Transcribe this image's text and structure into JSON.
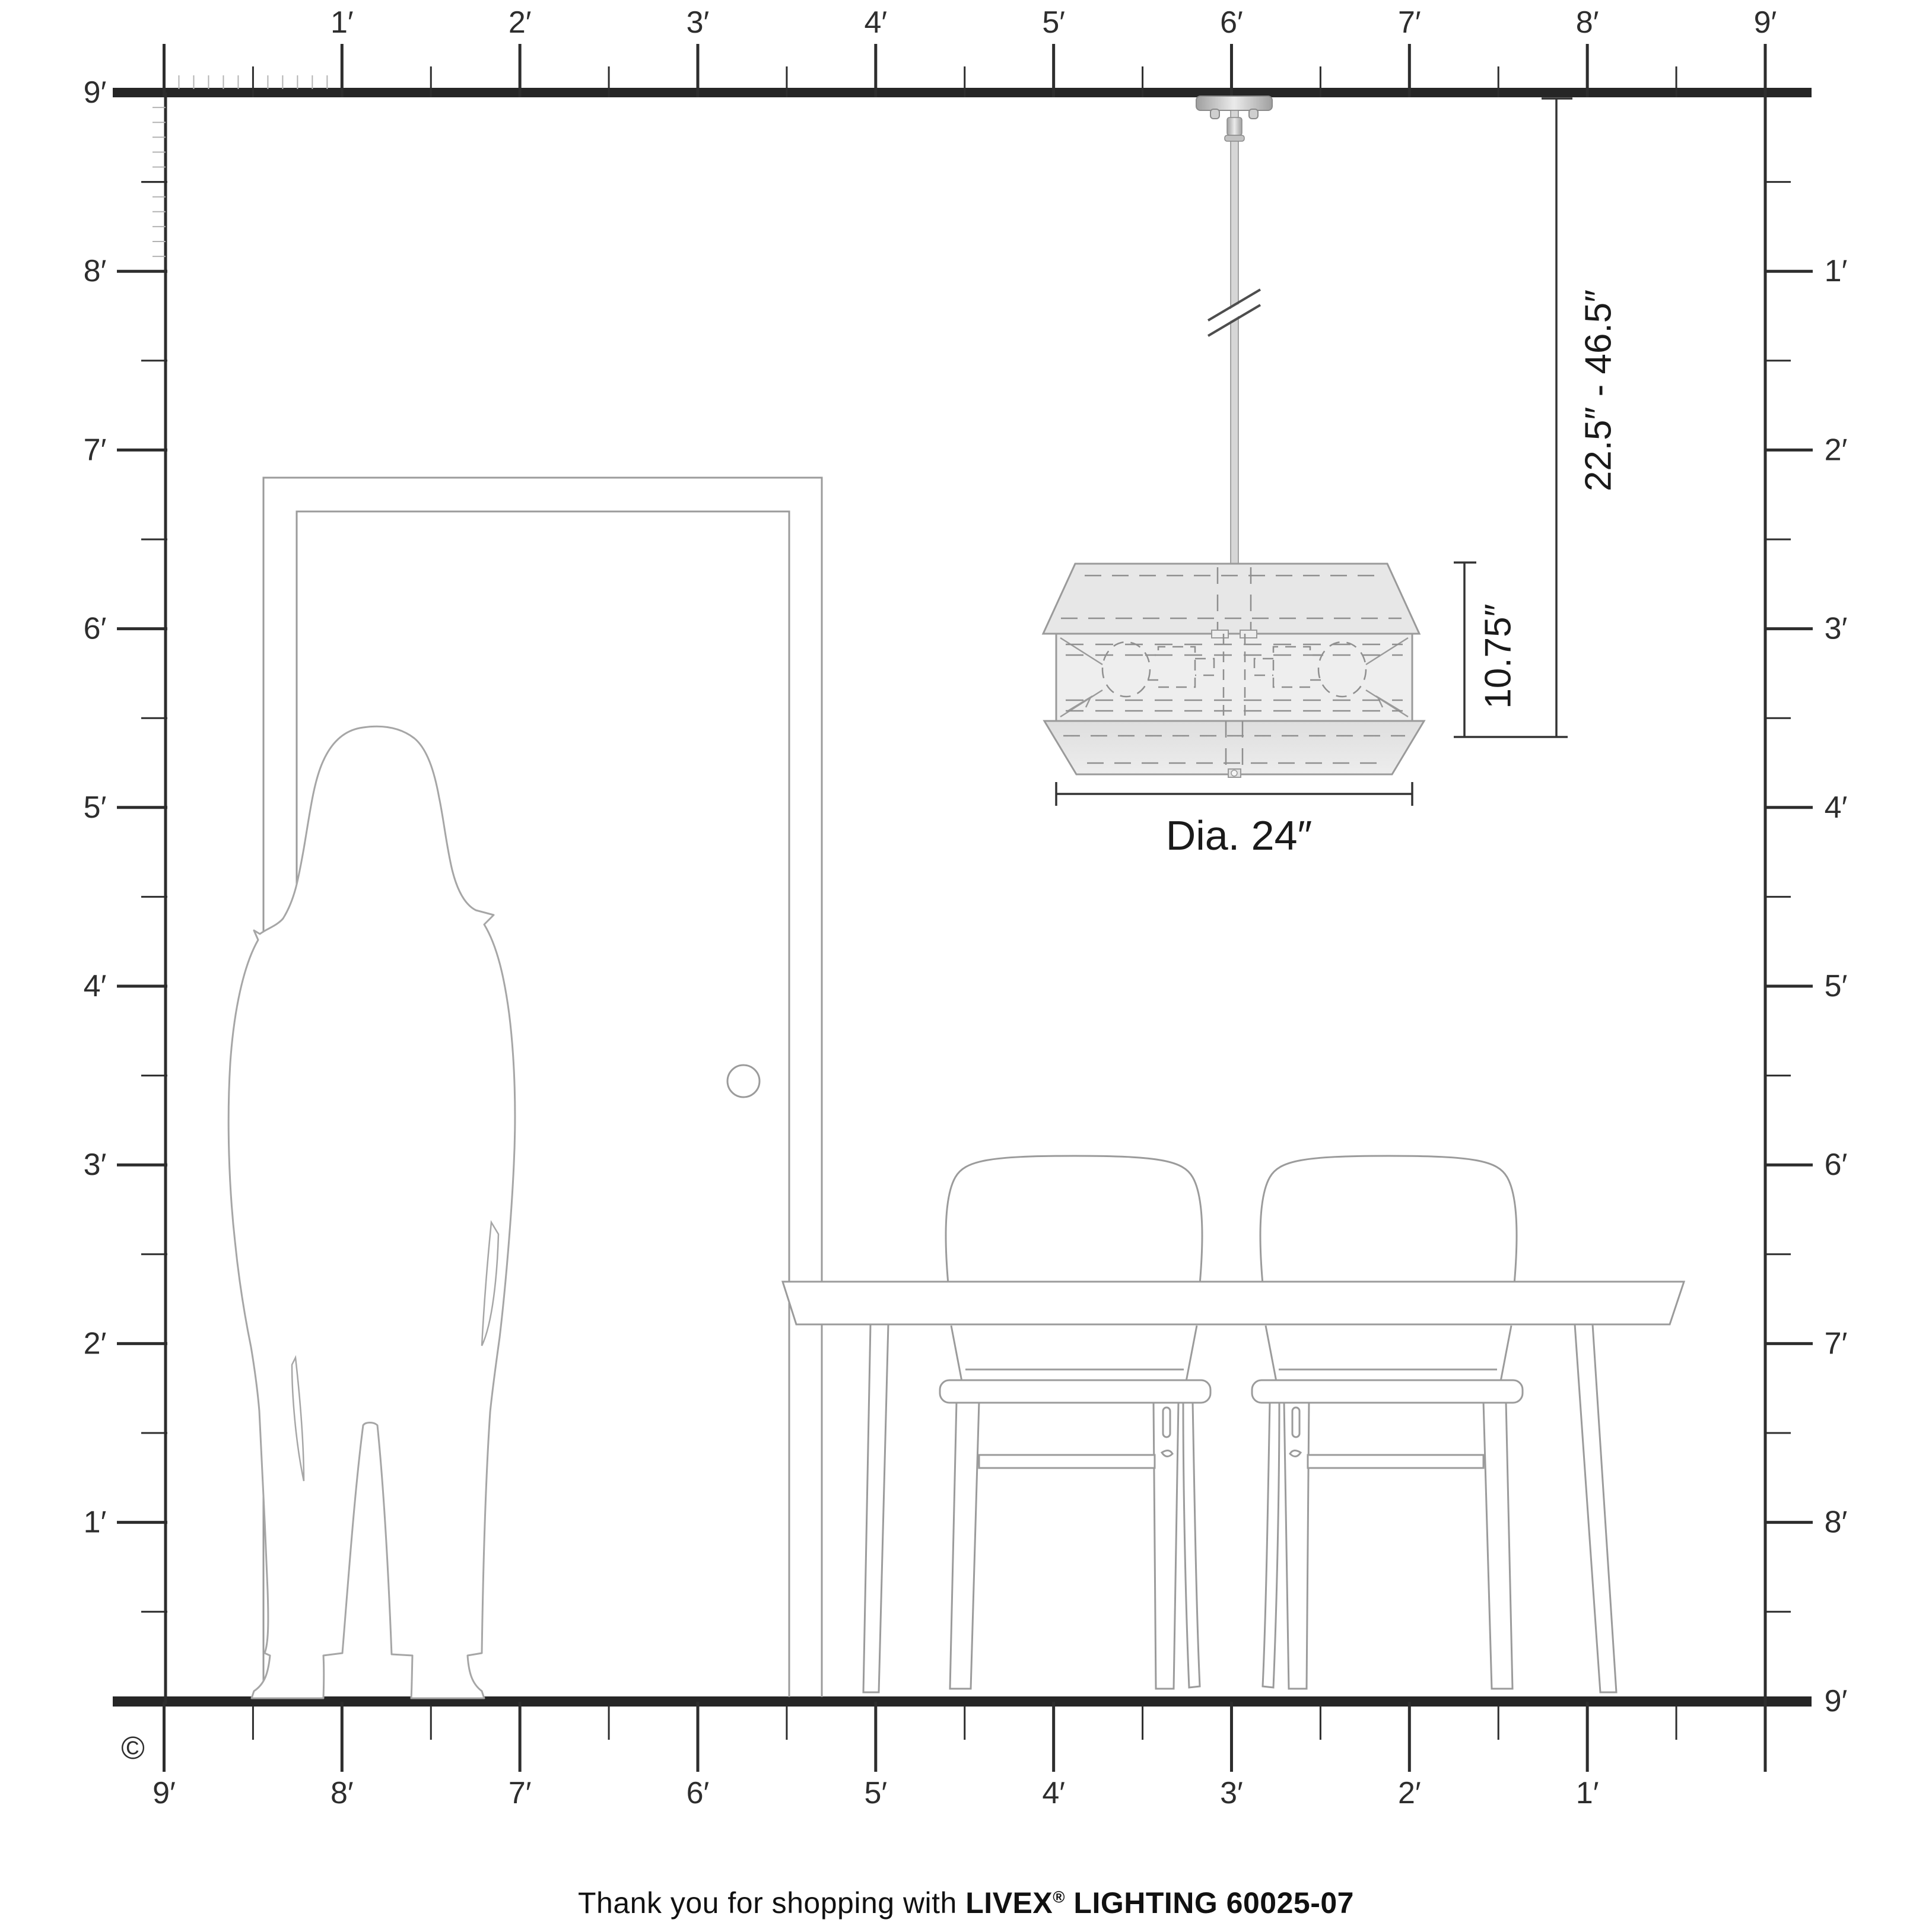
{
  "rulers": {
    "top": {
      "labels": [
        "1′",
        "2′",
        "3′",
        "4′",
        "5′",
        "6′",
        "7′",
        "8′",
        "9′"
      ]
    },
    "left": {
      "labels": [
        "9′",
        "8′",
        "7′",
        "6′",
        "5′",
        "4′",
        "3′",
        "2′",
        "1′"
      ]
    },
    "right": {
      "labels": [
        "1′",
        "2′",
        "3′",
        "4′",
        "5′",
        "6′",
        "7′",
        "8′",
        "9′"
      ]
    },
    "bottom": {
      "labels": [
        "9′",
        "8′",
        "7′",
        "6′",
        "5′",
        "4′",
        "3′",
        "2′",
        "1′"
      ]
    }
  },
  "annotations": {
    "hang_range": "22.5″ - 46.5″",
    "fixture_height": "10.75″",
    "diameter": "Dia. 24″"
  },
  "footer": {
    "prefix": "Thank you for shopping with ",
    "brand": "LIVEX",
    "registered": "®",
    "product": " LIGHTING 60025-07"
  },
  "copyright": "©",
  "colors": {
    "band": "#262626",
    "tick": "#2d2d2d",
    "inch_tick": "#b3b3b3",
    "furniture_line": "#9b9b9b",
    "silhouette_line": "#a6a6a6",
    "fixture_line": "#9a9a9a",
    "fixture_fill": "#e9e9e9",
    "fixture_fill_light": "#efefef",
    "dash": "#8f8f8f",
    "dim_line": "#333333",
    "metal_dark": "#9f9f9f",
    "metal_light": "#e8e8e8"
  }
}
